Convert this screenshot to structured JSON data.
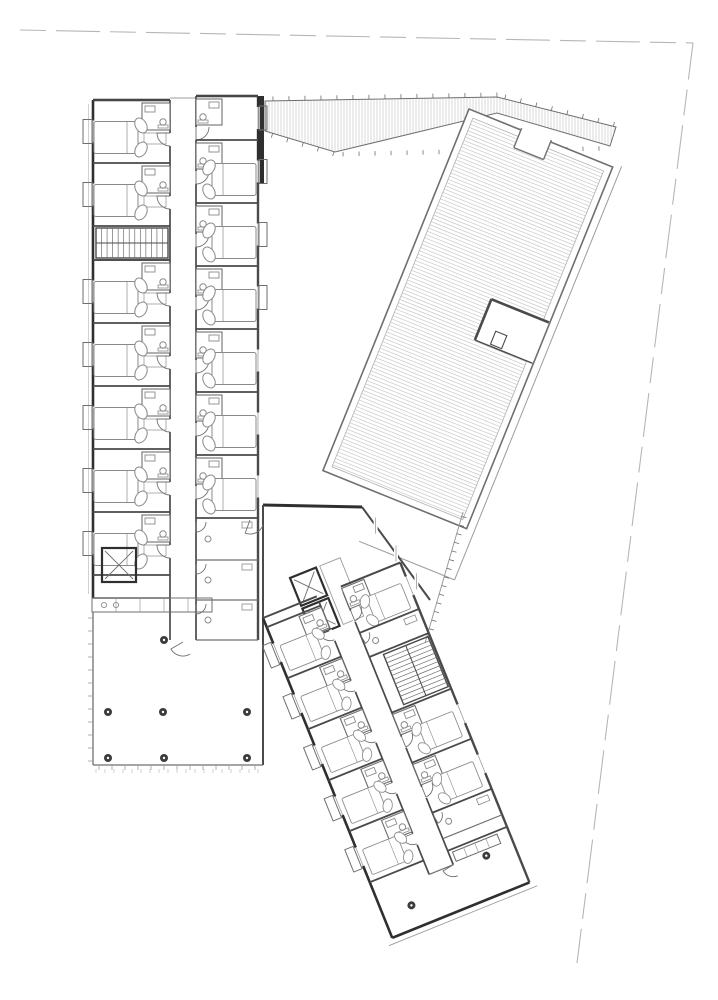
{
  "document": {
    "kind": "architectural floor plan drawing",
    "description": "Monochrome residential floor plan: vertical room wing at left, hatched roof terrace at upper right, rotated room wing at lower right, ground-floor lobby, dashed site boundary",
    "paper_color": "#ffffff"
  },
  "palette": {
    "wall_dark": "#2f2f2f",
    "wall": "#4a4a4a",
    "wall_medium": "#6f6f6f",
    "thin": "#9c9c9c",
    "faint": "#c4c4c4",
    "hatch": "#c9c9c9",
    "boundary_dash": "#b6b6b6",
    "column_fill": "#3c3c3c",
    "fixture": "#8a8a8a",
    "paper": "#ffffff"
  },
  "icons": {
    "bed": "bed-icon",
    "door_swing": "door-swing-icon",
    "toilet": "toilet-icon",
    "sink": "sink-icon",
    "stair": "stair-icon",
    "elevator_cross": "elevator-x-icon",
    "column": "column-icon"
  },
  "site": {
    "boundary_points": [
      [
        20,
        30
      ],
      [
        693,
        43
      ],
      [
        577,
        963
      ]
    ],
    "dash_pattern": "26 10 44 10"
  },
  "canopy": {
    "outline": [
      [
        265,
        101
      ],
      [
        497,
        97
      ],
      [
        616,
        127
      ],
      [
        610,
        146
      ],
      [
        497,
        113
      ],
      [
        335,
        152
      ],
      [
        265,
        131
      ]
    ],
    "hatch_step": 3,
    "tick_step": 16
  },
  "roof_terrace": {
    "origin": [
      469,
      109
    ],
    "rotation_deg": 22,
    "width": 155,
    "length": 390,
    "hatch_step": 3.5,
    "inner_inset": 7,
    "notch": {
      "x": 56,
      "y": -3,
      "w": 32,
      "h": 22
    },
    "access": {
      "x": 92,
      "y": 168,
      "w": 62,
      "h": 44,
      "inner": {
        "x": 108,
        "y": 196,
        "w": 12,
        "h": 14
      }
    },
    "parapet_offset": 8
  },
  "north_wing": {
    "west_band": {
      "x0": 93,
      "x1": 170,
      "top": 100,
      "bottom": 598,
      "rooms": [
        [
          100,
          163
        ],
        [
          163,
          226
        ],
        [
          260,
          323
        ],
        [
          323,
          386
        ],
        [
          386,
          449
        ],
        [
          449,
          512
        ],
        [
          512,
          575
        ]
      ],
      "stair": {
        "x": 96,
        "y": 228,
        "w": 72,
        "h": 30,
        "treads": 13
      }
    },
    "east_band": {
      "x0": 196,
      "x1": 258,
      "top": 96,
      "bottom": 640,
      "rooms": [
        [
          96,
          140
        ],
        [
          140,
          203
        ],
        [
          203,
          266
        ],
        [
          266,
          329
        ],
        [
          329,
          392
        ],
        [
          392,
          455
        ],
        [
          455,
          518
        ]
      ],
      "service_rooms": [
        [
          518,
          560
        ],
        [
          560,
          600
        ],
        [
          600,
          640
        ]
      ],
      "balcony_below_y": 300
    },
    "corridor": {
      "x0": 170,
      "x1": 196,
      "y0": 100,
      "y1": 640
    },
    "elevator": {
      "x": 102,
      "y": 548,
      "w": 34,
      "h": 34
    },
    "counter": {
      "x": 92,
      "y": 598,
      "w": 120,
      "h": 14,
      "divisions": 5
    },
    "corner_pier": {
      "x": 257,
      "y": 96,
      "w": 7,
      "h": 88
    }
  },
  "junction": {
    "north_wall": [
      [
        263,
        505
      ],
      [
        362,
        507
      ]
    ],
    "facade": [
      [
        362,
        507
      ],
      [
        430,
        600
      ]
    ],
    "east_wall": {
      "x": 263,
      "y0": 505,
      "y1": 765
    },
    "fence": {
      "from": [
        463,
        512
      ],
      "to": [
        425,
        643
      ],
      "tick_step": 9
    },
    "elevators": {
      "origin": [
        290,
        578
      ],
      "rotation_deg": -22,
      "shaft_w": 28,
      "shaft_h": 30,
      "count": 2,
      "gap": 3
    }
  },
  "south_wing": {
    "origin": [
      263,
      618
    ],
    "rotation_deg": -22,
    "width": 148,
    "length": 345,
    "corridor": {
      "x0": 58,
      "x1": 84,
      "y0": 6,
      "y1": 300
    },
    "sw_rooms": [
      [
        10,
        65
      ],
      [
        65,
        120
      ],
      [
        120,
        175
      ],
      [
        175,
        230
      ],
      [
        230,
        285
      ]
    ],
    "ne_elements": [
      {
        "type": "room",
        "y0": 0,
        "y1": 50
      },
      {
        "type": "bath",
        "y0": 50,
        "y1": 76
      },
      {
        "type": "stair",
        "y0": 76,
        "y1": 136
      },
      {
        "type": "room",
        "y0": 136,
        "y1": 190
      },
      {
        "type": "room",
        "y0": 190,
        "y1": 244
      },
      {
        "type": "bath",
        "y0": 244,
        "y1": 272
      }
    ],
    "end_room": {
      "y0": 285,
      "y1": 345,
      "columns": [
        [
          30,
          322
        ],
        [
          118,
          304
        ]
      ],
      "counter": {
        "x": 88,
        "y": 288,
        "w": 48,
        "h": 10
      }
    }
  },
  "lobby": {
    "x0": 93,
    "y0": 612,
    "x1": 263,
    "y1": 765,
    "mullion_step": 13,
    "columns": [
      [
        108,
        712
      ],
      [
        163,
        712
      ],
      [
        247,
        712
      ],
      [
        108,
        758
      ],
      [
        164,
        758
      ],
      [
        247,
        758
      ],
      [
        164,
        640
      ]
    ],
    "pavement_ticks": {
      "y": 769,
      "x0": 96,
      "x1": 260,
      "step": 9
    }
  }
}
